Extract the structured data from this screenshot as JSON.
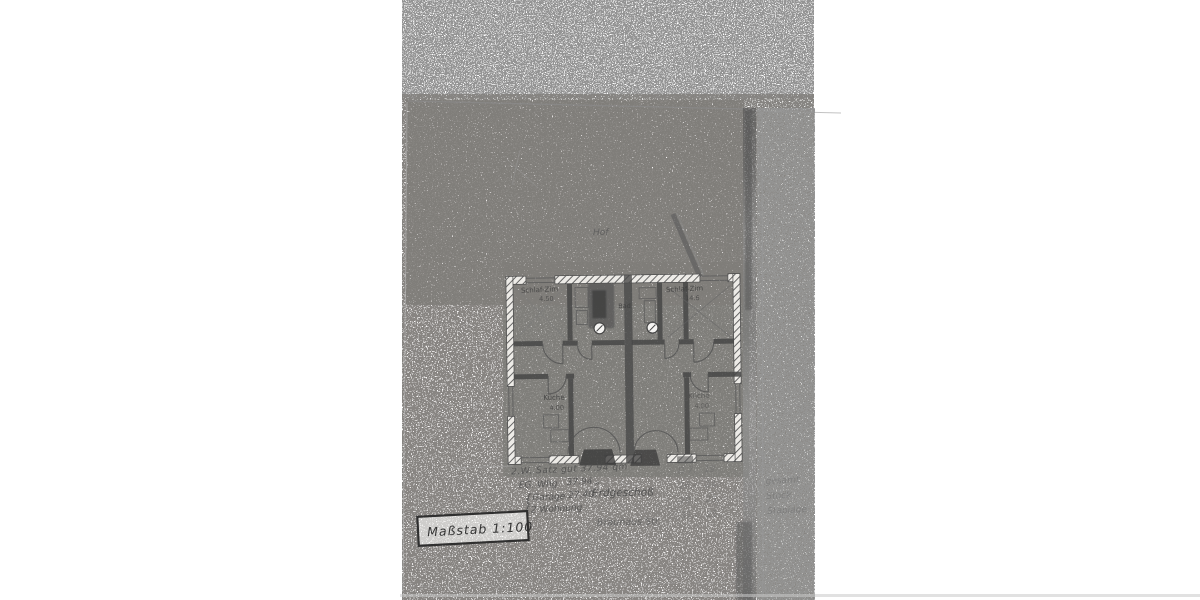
{
  "plan": {
    "courtyard_label": "Hof",
    "rooms": [
      {
        "name": "Schlaf-Zim",
        "area": "4.50"
      },
      {
        "name": "Bad",
        "area": ""
      },
      {
        "name": "Schlaf-Zim",
        "area": "14.6"
      },
      {
        "name": "Küche",
        "area": "4.00"
      },
      {
        "name": "Küche",
        "area": "4.00"
      }
    ]
  },
  "notes": {
    "line1": "2.W. Satz gut 37.94 qm",
    "line2_label": "EG. Whg",
    "line2_value": "37.94 „",
    "line3_brace": "{",
    "line3_label": "Garage",
    "line3_value": "27.40",
    "line4_brace": "{",
    "line4_label": "2 Wohnung",
    "floor": "Erdgeschoß",
    "street": "Brauhaus Str."
  },
  "scale_box": {
    "label": "Maßstab 1:100"
  },
  "faint_notes": {
    "rows": [
      {
        "c1": "D 7.",
        "c2": "19",
        "c3": ""
      },
      {
        "c1": "26,-",
        "c2": "24,-",
        "c3": "gesamt"
      },
      {
        "c1": "29,-",
        "c2": "25,-",
        "c3": "Stock"
      },
      {
        "c1": "31,-",
        "c2": "25,-",
        "c3": "Staplage"
      }
    ]
  }
}
